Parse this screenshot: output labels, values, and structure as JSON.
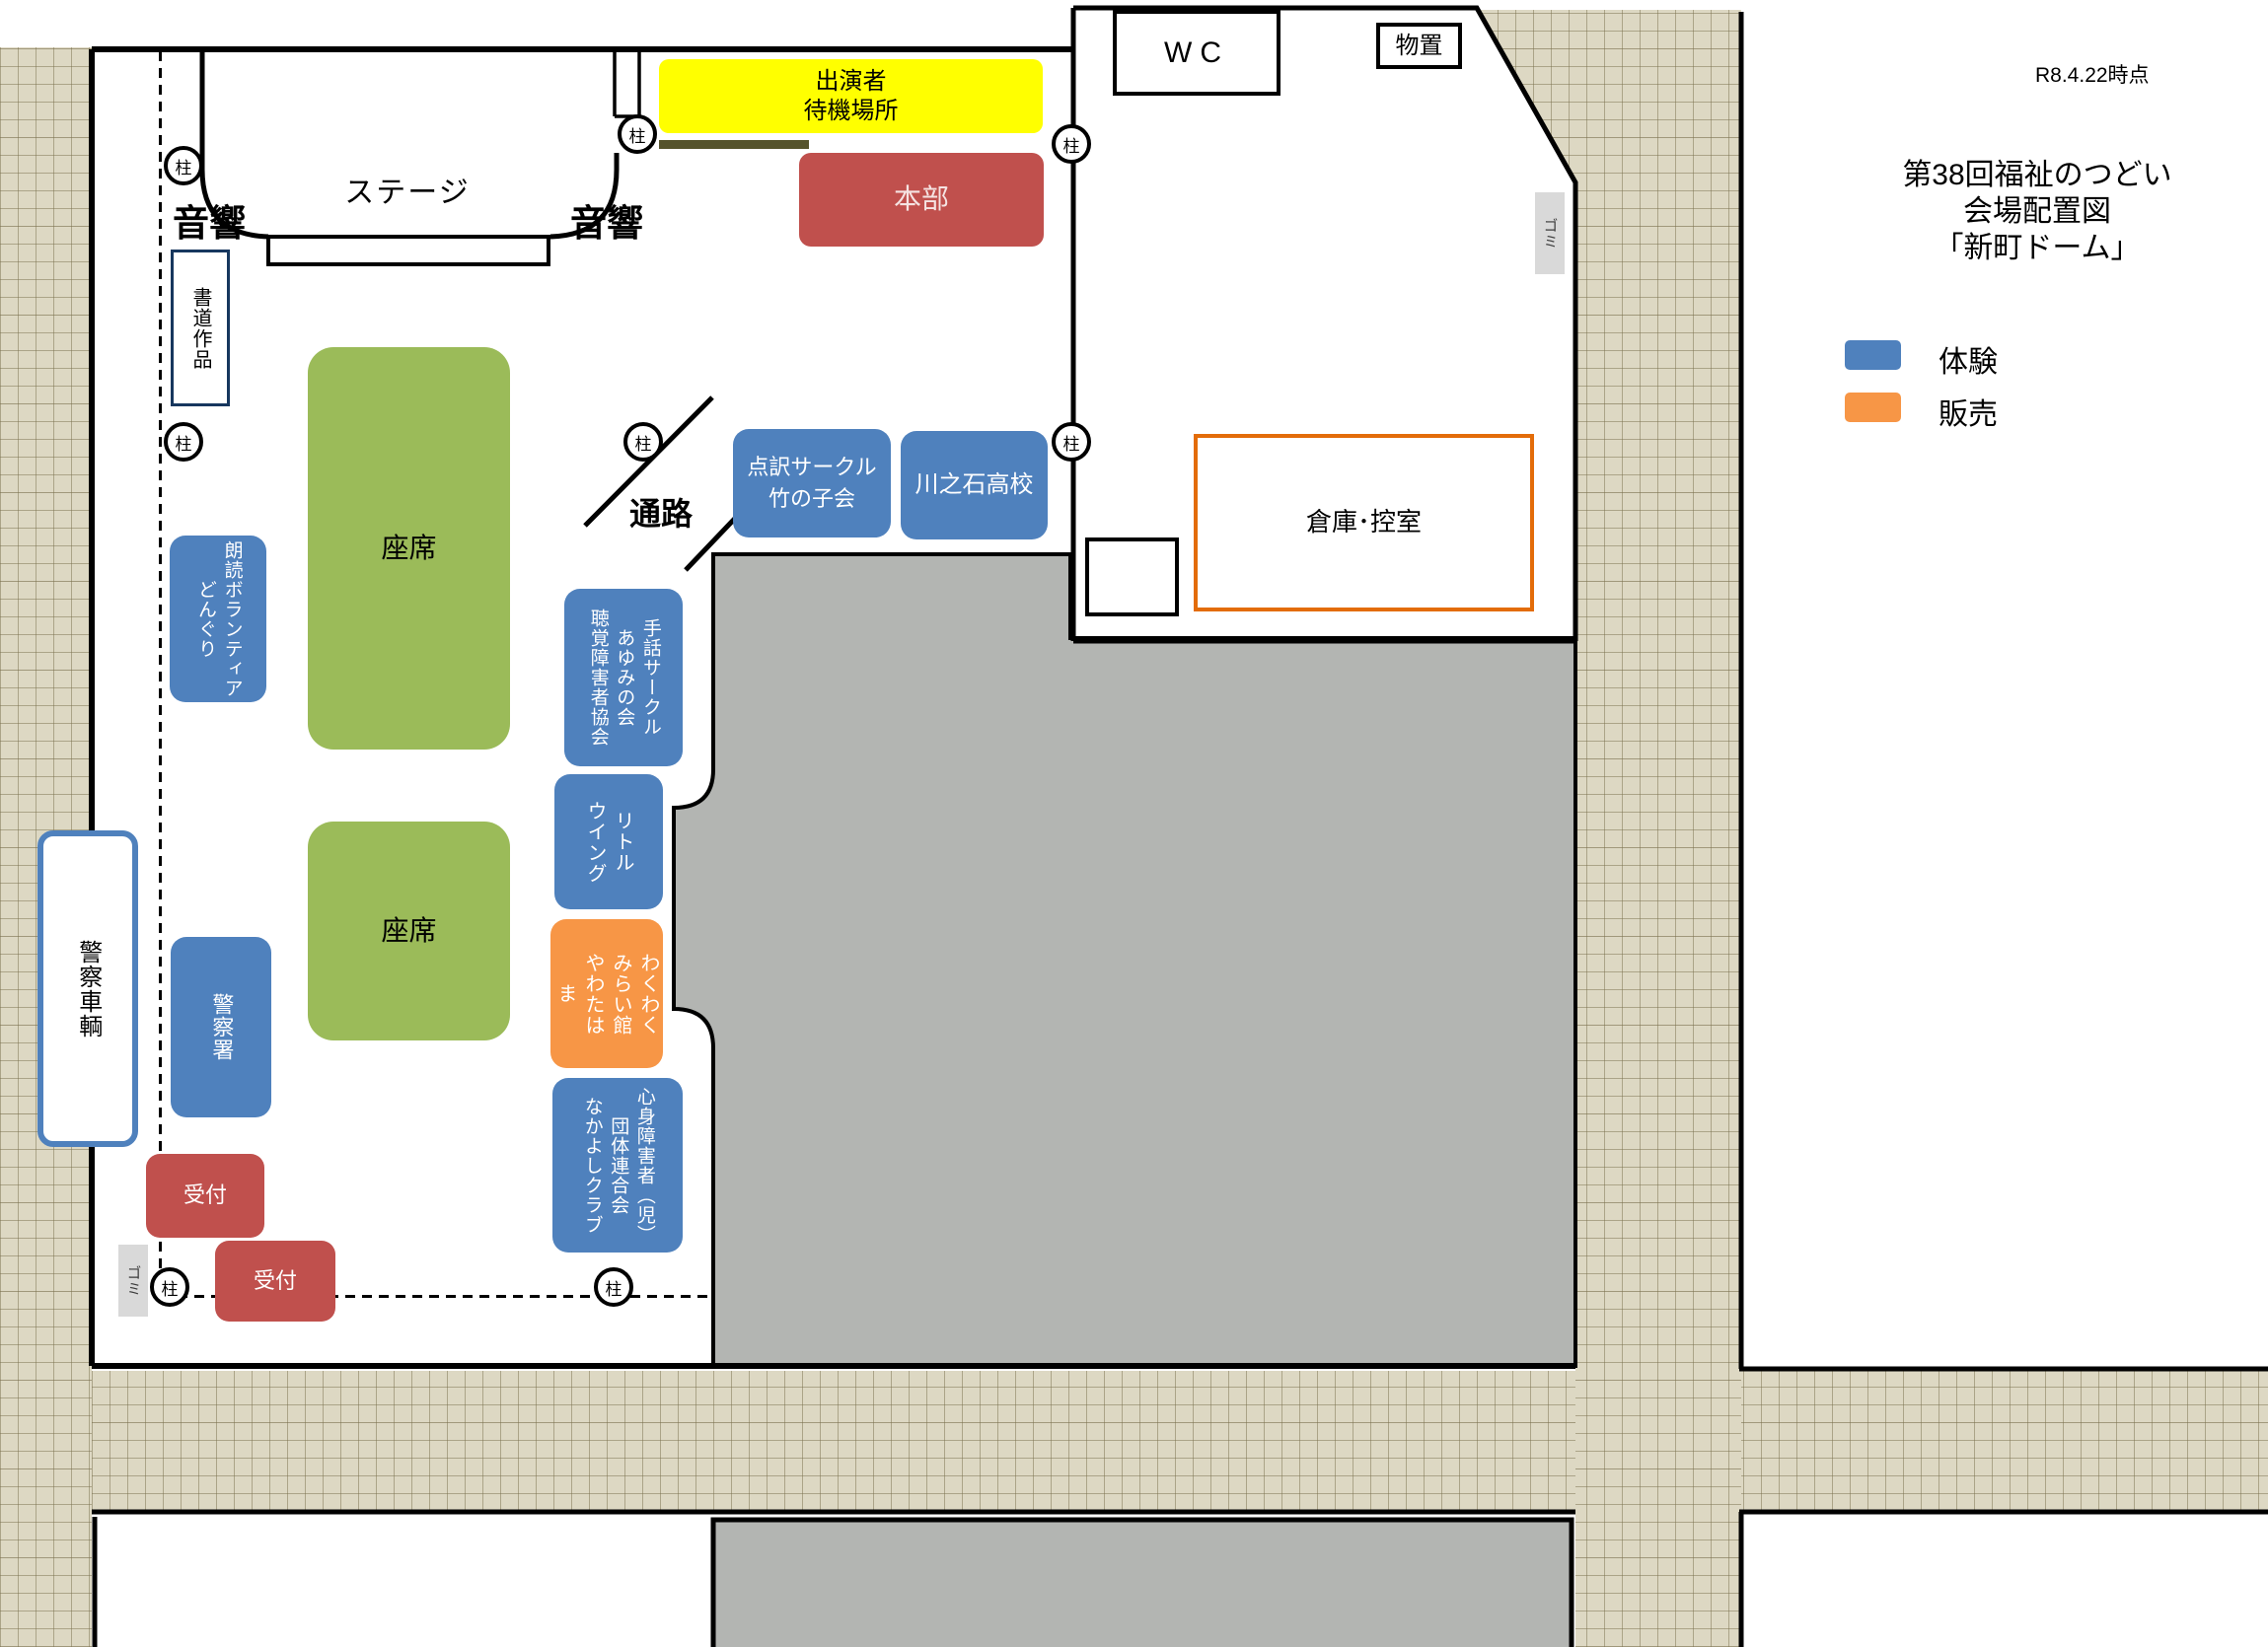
{
  "meta": {
    "timestamp": "R8.4.22時点",
    "title": "第38回福祉のつどい\n会場配置図\n「新町ドーム」"
  },
  "legend": {
    "items": [
      {
        "label": "体験",
        "color": "#4f81bd"
      },
      {
        "label": "販売",
        "color": "#f79646"
      }
    ]
  },
  "colors": {
    "blue": "#4f81bd",
    "orange": "#f79646",
    "green": "#9bbb59",
    "red": "#c0504d",
    "yellow": "#ffff00",
    "warehouse_border": "#e36c09",
    "gray_area": "#b3b5b2",
    "police_border": "#4f81bd",
    "calligraphy_border": "#17375e"
  },
  "labels": {
    "pillar": "柱",
    "trash": "ゴミ",
    "stage": "ステージ",
    "sound_left": "音響",
    "sound_right": "音響",
    "aisle": "通路",
    "seats_front": "座席",
    "seats_back": "座席",
    "wc": "WC",
    "shed": "物置",
    "warehouse": "倉庫･控室",
    "performer_waiting": "出演者\n待機場所",
    "headquarters": "本部",
    "calligraphy": "書道作品",
    "reception_1": "受付",
    "reception_2": "受付"
  },
  "booths": {
    "tenyaku": "点訳サークル\n竹の子会",
    "kawanoishi": "川之石高校",
    "shuwa": "手話サークル\nあゆみの会\n聴覚障害者協会",
    "littlewing": "リトル\nウイング",
    "wakuwaku": "わくわく\nみらい館\nやわたは\nま",
    "shinshin": "心身障害者（児）\n団体連合会\nなかよしクラブ",
    "roudoku": "朗読ボランティア\nどんぐり",
    "police_station": "警察署",
    "police_vehicle": "警察車輌"
  }
}
